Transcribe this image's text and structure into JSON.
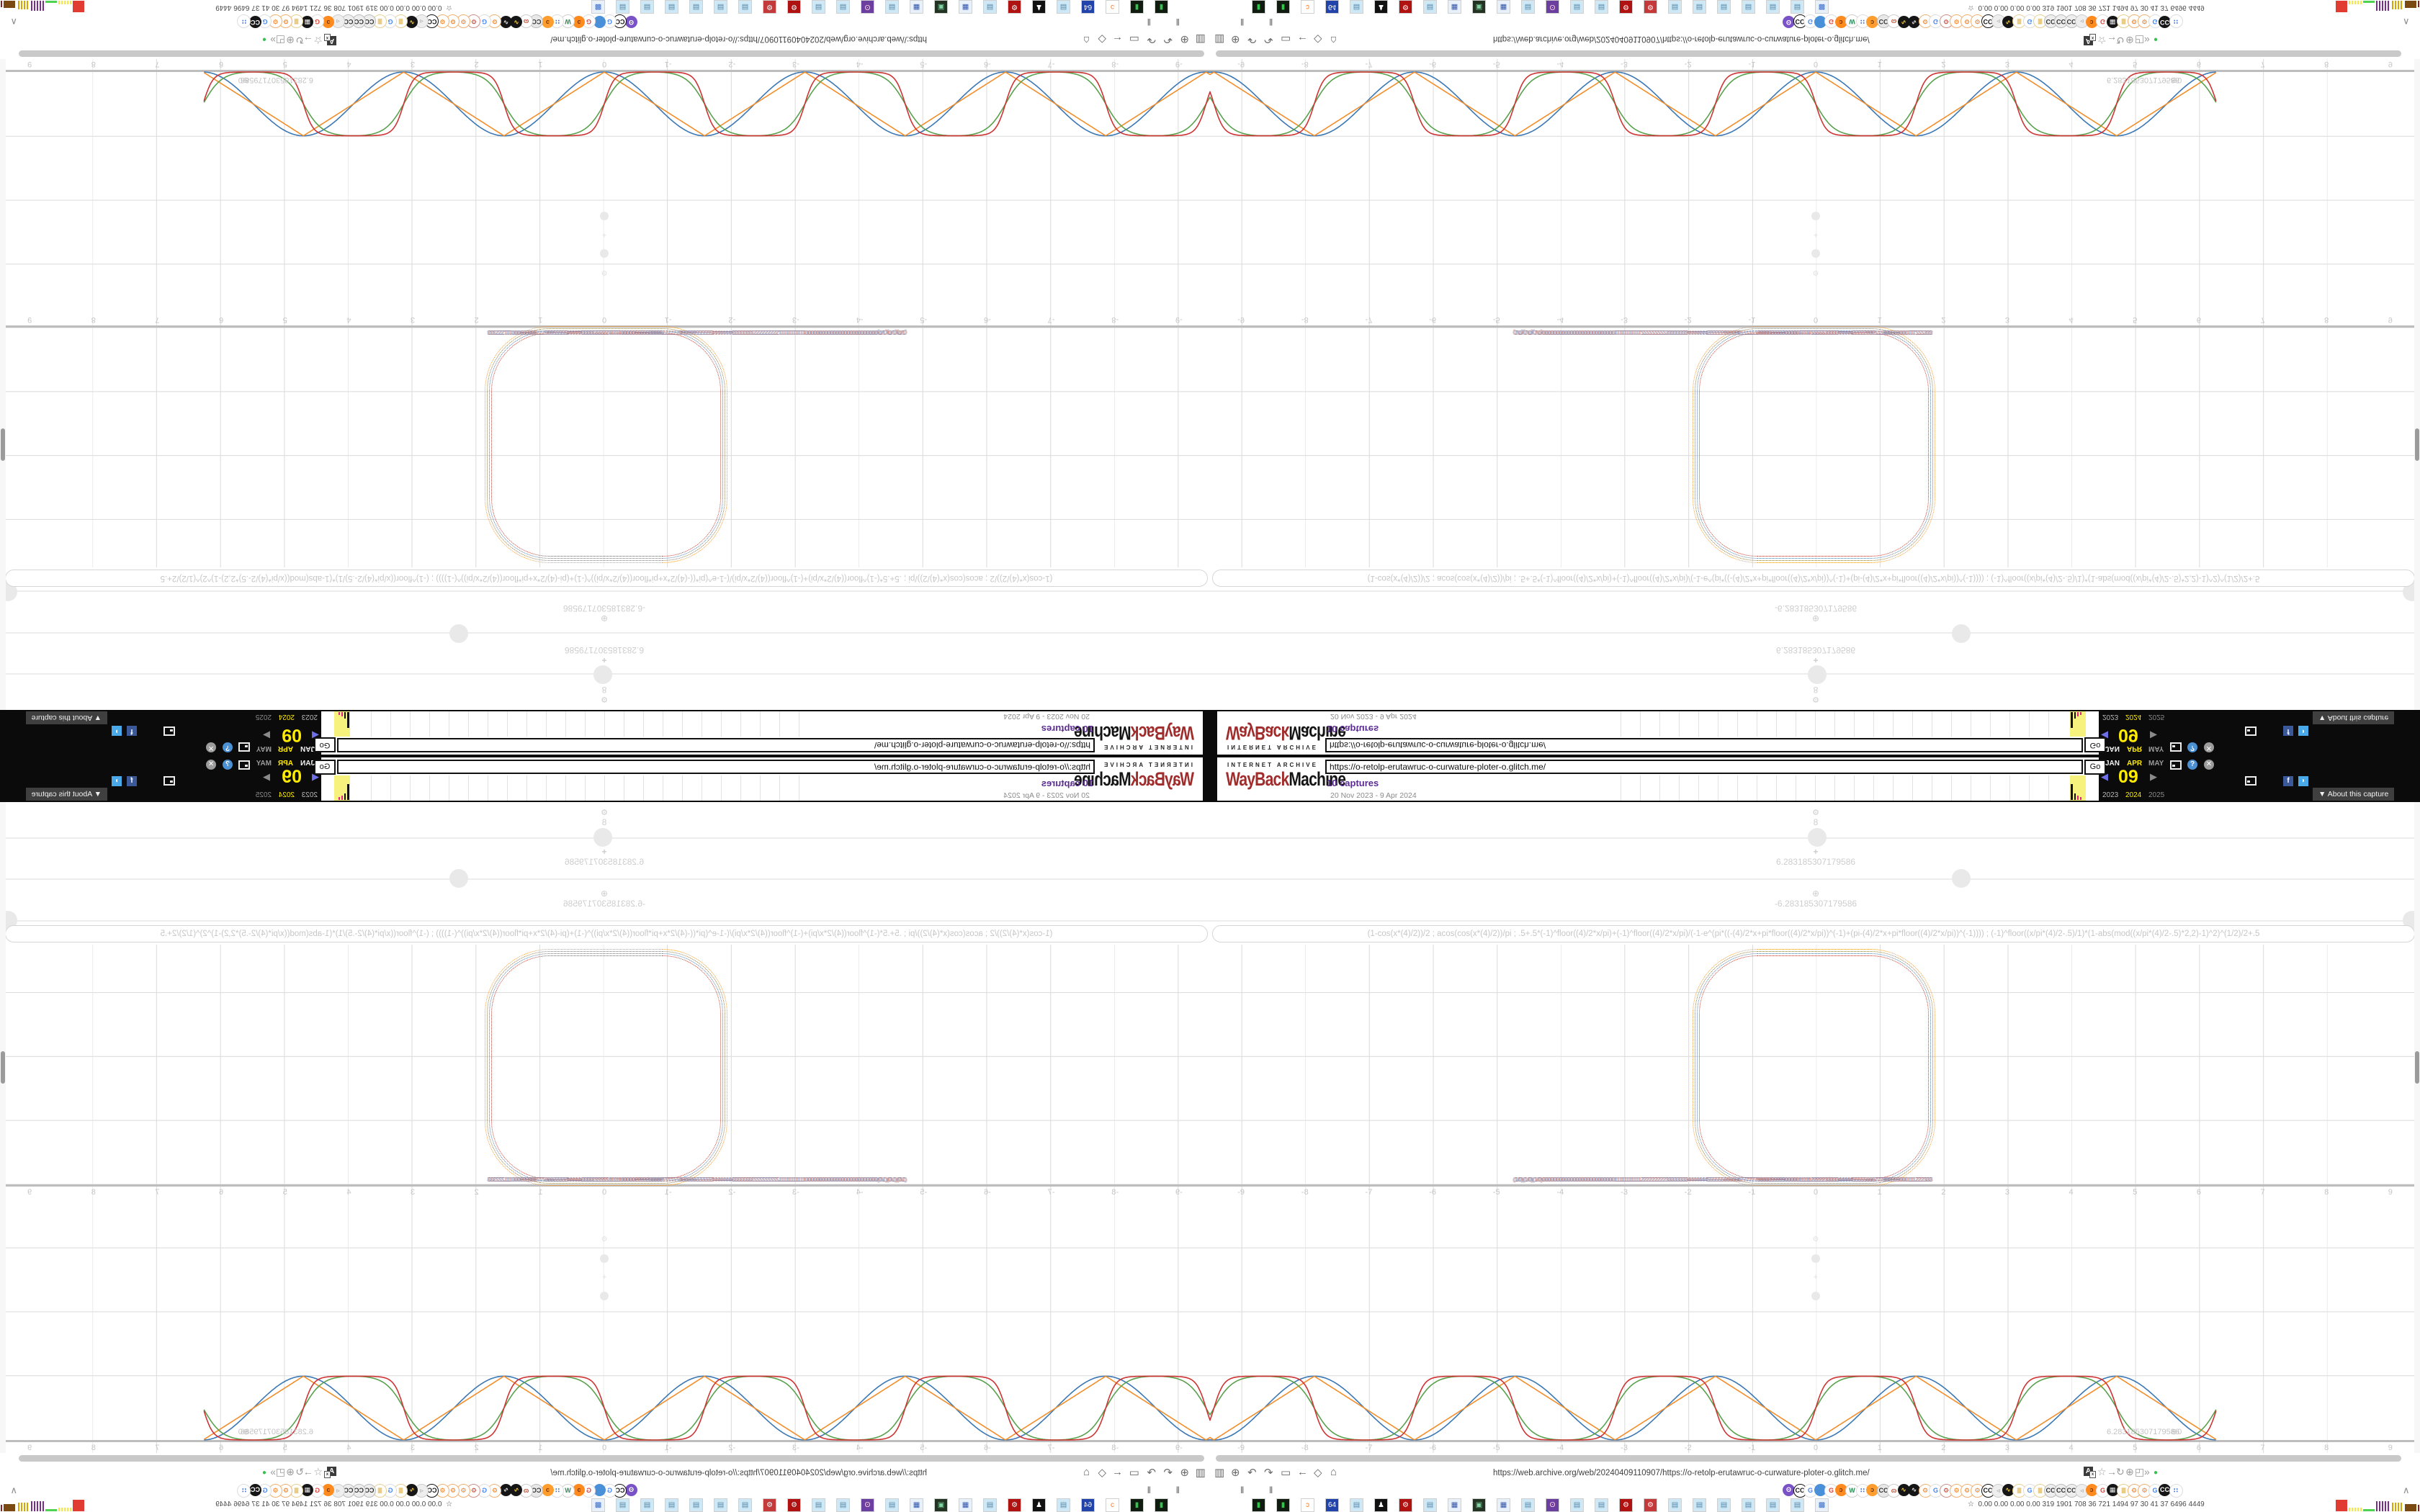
{
  "wayback_banner": {
    "archive_label": "INTERNET ARCHIVE",
    "logo_red": "WayBack",
    "logo_black": "Machine",
    "url_input_value": "https://o-retolp-erutawruc-o-curwature-ploter-o.glitch.me/",
    "go_label": "Go",
    "captures_link": "10 captures",
    "capture_range": "20 Nov 2023 - 9 Apr 2024",
    "months": [
      {
        "label": "JAN",
        "color": "#f0f0f0",
        "x": 6
      },
      {
        "label": "APR",
        "color": "#ffec00",
        "x": 36
      },
      {
        "label": "MAY",
        "color": "#9a9a9a",
        "x": 66
      }
    ],
    "day": "09",
    "prev_arrow": "◀",
    "next_arrow": "▶",
    "prev_color": "#6f6fe8",
    "next_color": "#8a8a8a",
    "years": [
      {
        "label": "2023",
        "color": "#b9b9b9",
        "x": 2
      },
      {
        "label": "2024",
        "color": "#ffec00",
        "x": 34
      },
      {
        "label": "2025",
        "color": "#8a8a8a",
        "x": 66
      }
    ],
    "help_glyph": "?",
    "close_glyph": "✕",
    "facebook_glyph": "f",
    "twitter_glyph": "◗",
    "help_color": "#4a90d2",
    "close_color": "#9c9c9c",
    "facebook_color": "#3b5998",
    "twitter_color": "#4aa9e8",
    "about_capture_label": "▼ About this capture",
    "sparkline": {
      "tick_count": 23,
      "yellow_bars": [
        {
          "x": 1,
          "w": 3,
          "h": 22,
          "c": "#111111"
        },
        {
          "x": 6,
          "w": 2,
          "h": 9,
          "c": "#111111"
        },
        {
          "x": 10,
          "w": 2,
          "h": 6,
          "c": "#e0218a"
        },
        {
          "x": 14,
          "w": 2,
          "h": 4,
          "c": "#e0218a"
        }
      ]
    }
  },
  "plotter": {
    "slider1_icon": "⚙",
    "slider1_value": "8",
    "slider2_icon": "+",
    "slider2_value": "6.283185307179586",
    "slider3_icon": "⊕",
    "slider3_value": "-6.283185307179586",
    "equation": "(1-cos(x*(4)/2))/2 ; acos(cos(x*(4)/2))/pi ; .5+.5*(-1)^floor((4)/2*x/pi)+(-1)^floor((4)/2*x/pi)/(-1-e^(pi*((-(4)/2*x+pi*floor((4)/2*x/pi))^(-1)+(pi-(4)/2*x+pi*floor((4)/2*x/pi))^(-1)))) ; (-1)^floor((x/pi*(4)/2-.5)/1)*(1-abs(mod((x/pi*(4)/2-.5)*2,2)-1)^2)^(1/2)/2+.5",
    "jumble_text": "(1/0)(1/0)(1/0)00000000000000000000000000111111111112222222223333333344444445555556666667777778888899999000001111122222333334444455555666777888999000111222333",
    "endpoint_label": "6.283185307179586",
    "endpoint_overlap": "⊕0",
    "tick_values": [
      -9,
      -8,
      -7,
      -6,
      -5,
      -4,
      -3,
      -2,
      -1,
      0,
      1,
      2,
      3,
      4,
      5,
      6,
      7,
      8,
      9
    ],
    "ring_colors": [
      "#f59c2f",
      "#8a7a44",
      "#4e79a7",
      "#c23b2e"
    ]
  },
  "chart_data": [
    {
      "type": "line",
      "title": "curvature plotter waves (lower panel)",
      "xlabel": "x",
      "ylabel": "",
      "x_range": [
        -9.49,
        6.283185307179586
      ],
      "ylim": [
        0,
        1
      ],
      "x_ticks": [
        -9,
        -8,
        -7,
        -6,
        -5,
        -4,
        -3,
        -2,
        -1,
        0,
        1,
        2,
        3,
        4,
        5,
        6,
        7,
        8,
        9
      ],
      "grid": true,
      "legend_position": "none",
      "series": [
        {
          "name": "(1-cos(x*(4)/2))/2",
          "key": "cos",
          "color": "#3c78b4"
        },
        {
          "name": "acos(cos(x*(4)/2))/pi",
          "key": "triangle",
          "color": "#f28e2b"
        },
        {
          "name": "semicircle-bump formula",
          "key": "steep",
          "color": "#59a14e"
        },
        {
          "name": "smoothed square formula",
          "key": "square",
          "color": "#cf3434"
        }
      ],
      "period": 3.141592653589793,
      "endpoint": [
        6.283185307179586,
        0
      ]
    },
    {
      "type": "line",
      "title": "squircle panel (upper): four concentric dotted rounded squares",
      "x_ticks": [
        -2,
        -1,
        0,
        1,
        2
      ],
      "x_span": [
        -1.9,
        1.85
      ],
      "colors": [
        "#f59c2f",
        "#8a7a44",
        "#4e79a7",
        "#c23b2e"
      ]
    }
  ],
  "browser": {
    "url_text": "https://web.archive.org/web/20240409110907/https://o-retolp-erutawruc-o-curwature-ploter-o.glitch.me/",
    "left_icon_glyphs": [
      "▥",
      "⊕",
      "↶",
      "↷",
      "▭",
      "←",
      "◇",
      "⌂"
    ],
    "left_icon_names": [
      "trash-icon",
      "globe-lines-icon",
      "undo-icon",
      "redo-icon",
      "folder-icon",
      "back-arrow-icon",
      "shield-icon",
      "lock-icon"
    ],
    "translate_glyph": "A",
    "right_icon_glyphs": [
      "☆",
      "→",
      "↻",
      "⊕",
      "◰",
      "»"
    ],
    "right_icon_names": [
      "bookmark-star-icon",
      "forward-arrow-icon",
      "reload-icon",
      "globe-icon",
      "extension-puzzle-icon",
      "overflow-chevrons-icon"
    ],
    "status_dot_glyph": "●",
    "pause_glyph": "‖",
    "overflow_chevron": "∧",
    "ext_icons": [
      {
        "t": "ʘ",
        "bg": "#7a52c7",
        "fg": "#ffffff"
      },
      {
        "t": "CC",
        "bg": "#ffffff",
        "fg": "#111111",
        "bd": "#111111"
      },
      {
        "t": "G",
        "bg": "#ffffff",
        "fg": "#4285f4",
        "bd": "#dddddd"
      },
      {
        "t": "",
        "bg": "#4a90d9",
        "fg": "#ffffff"
      },
      {
        "t": "G",
        "bg": "#ffffff",
        "fg": "#db4437",
        "bd": "#dddddd"
      },
      {
        "t": "ɔ",
        "bg": "#ff8a1e",
        "fg": "#7a3505"
      },
      {
        "t": "W",
        "bg": "#ffffff",
        "fg": "#2e8b57",
        "bd": "#cccccc"
      },
      {
        "t": "∷",
        "bg": "#ffffff",
        "fg": "#3b6fd4",
        "bd": "#dddddd"
      },
      {
        "t": "ɔ",
        "bg": "#ff9e2e",
        "fg": "#7a3505"
      },
      {
        "t": "CC",
        "bg": "#e8e8e8",
        "fg": "#333333",
        "bd": "#bbbbbb"
      },
      {
        "t": "ɷ",
        "bg": "#ffffff",
        "fg": "#c0553a",
        "bd": "#cccccc"
      },
      {
        "t": "∿",
        "bg": "#151515",
        "fg": "#ffd23f"
      },
      {
        "t": "∿",
        "bg": "#151515",
        "fg": "#f0f0f0"
      },
      {
        "t": "⚙",
        "bg": "#ffffff",
        "fg": "#f07818",
        "bd": "#f0b070"
      },
      {
        "t": "G",
        "bg": "#ffffff",
        "fg": "#4285f4",
        "bd": "#dddddd"
      },
      {
        "t": "⚙",
        "bg": "#ffffff",
        "fg": "#c0392b",
        "bd": "#d09088"
      },
      {
        "t": "⚙",
        "bg": "#ffffff",
        "fg": "#f07818",
        "bd": "#f0b070"
      },
      {
        "t": "⚙",
        "bg": "#ffffff",
        "fg": "#f07818",
        "bd": "#f0b070"
      },
      {
        "t": "⚙",
        "bg": "#ffffff",
        "fg": "#f07818",
        "bd": "#f0b070"
      },
      {
        "t": "CC",
        "bg": "#ffffff",
        "fg": "#111111",
        "bd": "#111111"
      },
      {
        "t": "◃",
        "bg": "#eeeeee",
        "fg": "#999999",
        "bd": "#cccccc"
      },
      {
        "t": "∿",
        "bg": "#151515",
        "fg": "#ffd23f"
      },
      {
        "t": "≣",
        "bg": "#ffffff",
        "fg": "#d9a62a",
        "bd": "#e8cf90"
      },
      {
        "t": "G",
        "bg": "#ffffff",
        "fg": "#4285f4",
        "bd": "#dddddd"
      },
      {
        "t": "≣",
        "bg": "#ffffff",
        "fg": "#d9a62a",
        "bd": "#e8cf90"
      },
      {
        "t": "CC",
        "bg": "#eeeeee",
        "fg": "#333333",
        "bd": "#bbbbbb"
      },
      {
        "t": "CC",
        "bg": "#eeeeee",
        "fg": "#333333",
        "bd": "#bbbbbb"
      },
      {
        "t": "CC",
        "bg": "#eeeeee",
        "fg": "#333333",
        "bd": "#bbbbbb"
      },
      {
        "t": "◃",
        "bg": "#eeeeee",
        "fg": "#999999",
        "bd": "#cccccc"
      },
      {
        "t": "ɔ",
        "bg": "#ff8a1e",
        "fg": "#7a3505"
      },
      {
        "t": "G",
        "bg": "#ffffff",
        "fg": "#db4437",
        "bd": "#dddddd"
      },
      {
        "t": "▦",
        "bg": "#151515",
        "fg": "#e8e8e8"
      },
      {
        "t": "≣",
        "bg": "#ffffff",
        "fg": "#d9a62a",
        "bd": "#e8cf90"
      },
      {
        "t": "⚙",
        "bg": "#ffffff",
        "fg": "#f07818",
        "bd": "#f0b070"
      },
      {
        "t": "⚙",
        "bg": "#ffffff",
        "fg": "#f07818",
        "bd": "#f0b070"
      },
      {
        "t": "G",
        "bg": "#ffffff",
        "fg": "#4285f4",
        "bd": "#dddddd"
      },
      {
        "t": "CC",
        "bg": "#151515",
        "fg": "#ffffff"
      },
      {
        "t": "∷",
        "bg": "#ffffff",
        "fg": "#3b6fd4",
        "bd": "#dddddd"
      }
    ],
    "task_squares": [
      {
        "t": "▮",
        "bg": "#101c10",
        "fg": "#35c24d"
      },
      {
        "t": "▮",
        "bg": "#101c10",
        "fg": "#35c24d"
      },
      {
        "t": "ɔ",
        "bg": "#ffffff",
        "fg": "#ff7a1e"
      },
      {
        "t": "64",
        "bg": "#2244aa",
        "fg": "#ffffff"
      },
      {
        "t": "▤",
        "bg": "#cfe8f5",
        "fg": "#5588aa"
      },
      {
        "t": "♟",
        "bg": "#111111",
        "fg": "#ffffff"
      },
      {
        "t": "⚙",
        "bg": "#b01212",
        "fg": "#ffffff"
      },
      {
        "t": "▤",
        "bg": "#cfe8f5",
        "fg": "#5588aa"
      },
      {
        "t": "▦",
        "bg": "#e8f0fa",
        "fg": "#3355aa"
      },
      {
        "t": "▣",
        "bg": "#223322",
        "fg": "#7fd2a0"
      },
      {
        "t": "▦",
        "bg": "#e8f0fa",
        "fg": "#3355aa"
      },
      {
        "t": "▤",
        "bg": "#cfe8f5",
        "fg": "#5588aa"
      },
      {
        "t": "ʘ",
        "bg": "#6a3fa0",
        "fg": "#ffd0e0"
      },
      {
        "t": "▤",
        "bg": "#cfe8f5",
        "fg": "#5588aa"
      },
      {
        "t": "▤",
        "bg": "#cfe8f5",
        "fg": "#5588aa"
      },
      {
        "t": "⚙",
        "bg": "#b01212",
        "fg": "#ffffff"
      },
      {
        "t": "⚙",
        "bg": "#c43a3a",
        "fg": "#ffffff"
      },
      {
        "t": "▤",
        "bg": "#cfe8f5",
        "fg": "#5588aa"
      },
      {
        "t": "▤",
        "bg": "#cfe8f5",
        "fg": "#5588aa"
      },
      {
        "t": "▤",
        "bg": "#cfe8f5",
        "fg": "#5588aa"
      },
      {
        "t": "▤",
        "bg": "#cfe8f5",
        "fg": "#5588aa"
      },
      {
        "t": "▤",
        "bg": "#cfe8f5",
        "fg": "#5588aa"
      },
      {
        "t": "▤",
        "bg": "#cfe8f5",
        "fg": "#5588aa"
      },
      {
        "t": "▩",
        "bg": "#e8f0fa",
        "fg": "#3a6fd0"
      }
    ],
    "status_prefix": "☆",
    "status_text": "0.00 0.00 0.00 0.00  319 1901 708  36  721 1494 97  30  41  37  6496 4449",
    "mini_graphs": [
      {
        "w": 16,
        "h": 16,
        "style": "solid",
        "c": "#e03c31"
      },
      {
        "w": 18,
        "h": 5,
        "style": "marks",
        "c": "#f5e642"
      },
      {
        "w": 16,
        "h": 3,
        "style": "solid",
        "c": "#4fd24f"
      },
      {
        "w": 20,
        "h": 14,
        "style": "marks",
        "c": "#7b2d8b"
      },
      {
        "w": 16,
        "h": 12,
        "style": "marks",
        "c": "#d7a500"
      },
      {
        "w": 16,
        "h": 10,
        "style": "solid",
        "c": "#7b4a12"
      },
      {
        "w": 22,
        "h": 9,
        "style": "marks",
        "c": "#8b2020"
      }
    ]
  },
  "layout_note_colors": {
    "accent_yellow": "#ffec00",
    "captures_purple": "#5b2d90",
    "logo_red": "#a02c2c"
  }
}
